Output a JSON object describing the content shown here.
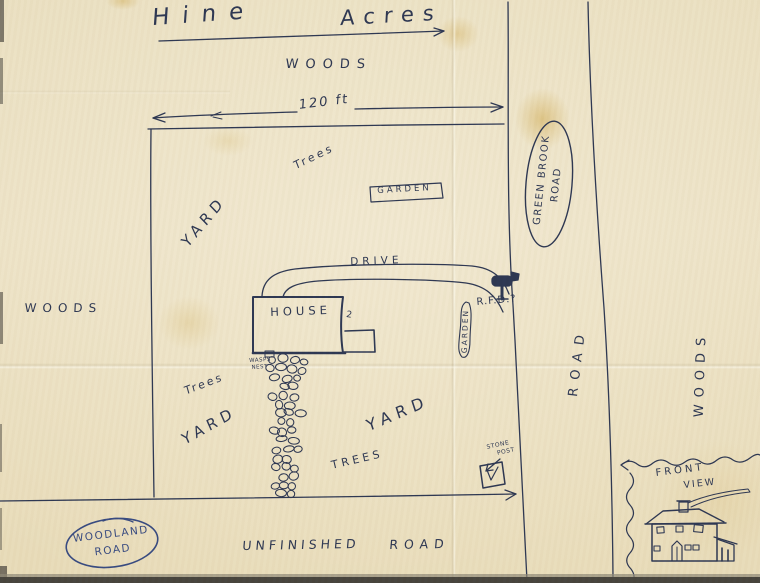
{
  "title": {
    "left": "Hine",
    "right": "Acres"
  },
  "dimension_label": "120 ft",
  "areas": {
    "woods_top": "WOODS",
    "woods_left": "WOODS",
    "woods_right": "WOODS",
    "yard_upper": "YARD",
    "yard_left": "YARD",
    "yard_mid": "YARD",
    "trees_top": "Trees",
    "trees_left": "Trees",
    "trees_mid": "TREES"
  },
  "roads": {
    "green_brook_line1": "GREEN BROOK",
    "green_brook_line2": "ROAD",
    "road_right": "ROAD",
    "woodland_line1": "WOODLAND",
    "woodland_line2": "ROAD",
    "unfinished_word1": "UNFINISHED",
    "unfinished_word2": "ROAD",
    "drive": "DRIVE"
  },
  "features": {
    "house": "HOUSE",
    "house_mark": "2",
    "garden_box": "GARDEN",
    "garden_strip": "GARDEN",
    "rfd": "R.F.D.?",
    "wasps_line1": "WASPS",
    "wasps_line2": "NEST",
    "stone_post_line1": "STONE",
    "stone_post_line2": "POST",
    "front_view_line1": "FRONT",
    "front_view_line2": "VIEW"
  },
  "drawings": [
    "dimension-arrow",
    "plot-boundary",
    "green-brook-road-lines",
    "driveway",
    "house-outline",
    "stone-walk",
    "mailbox-icon",
    "garden-box",
    "garden-strip",
    "stone-post-box",
    "front-view-house",
    "woodland-road-oval",
    "green-brook-road-oval",
    "title-underline-arrow"
  ],
  "colors": {
    "ink": "#2b3551",
    "ink_blue": "#35487f",
    "paper": "#ebe0c2"
  }
}
